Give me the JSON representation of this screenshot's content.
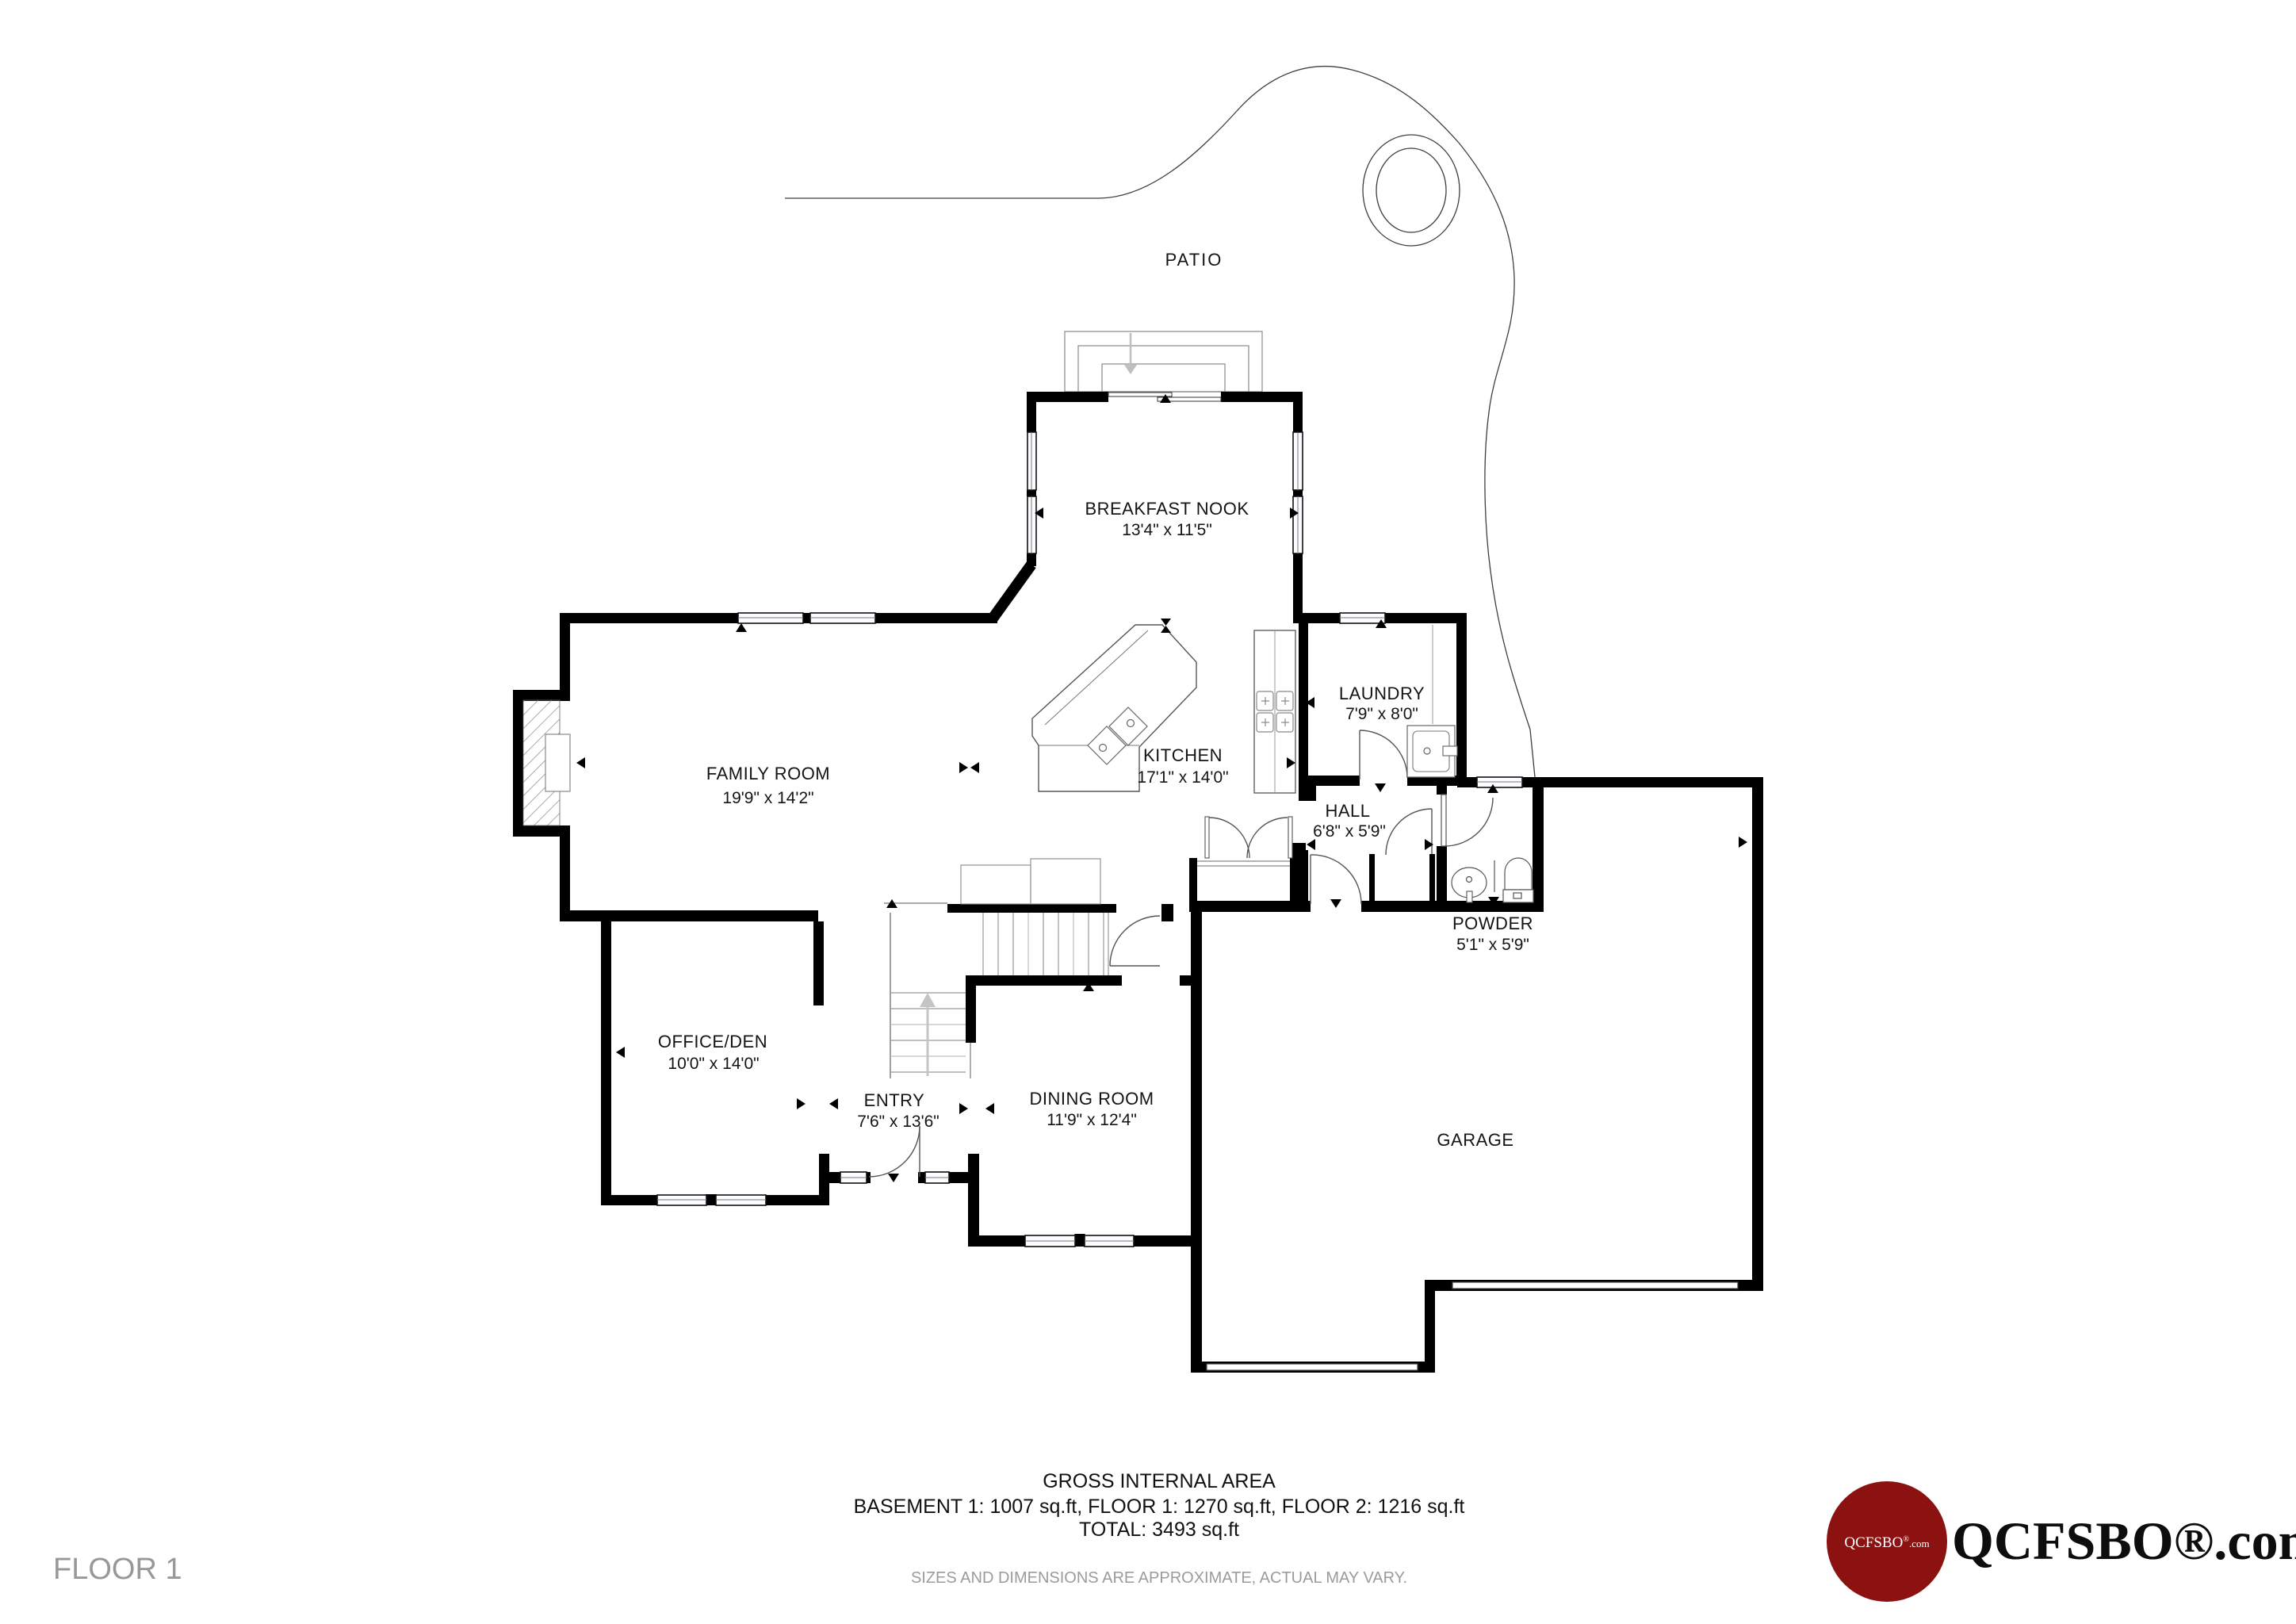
{
  "floor_label": "FLOOR 1",
  "rooms": [
    {
      "name": "PATIO",
      "dims": ""
    },
    {
      "name": "BREAKFAST NOOK",
      "dims": "13'4\" x 11'5\""
    },
    {
      "name": "FAMILY ROOM",
      "dims": "19'9\" x 14'2\""
    },
    {
      "name": "KITCHEN",
      "dims": "17'1\" x 14'0\""
    },
    {
      "name": "LAUNDRY",
      "dims": "7'9\" x 8'0\""
    },
    {
      "name": "HALL",
      "dims": "6'8\" x 5'9\""
    },
    {
      "name": "POWDER",
      "dims": "5'1\" x 5'9\""
    },
    {
      "name": "OFFICE/DEN",
      "dims": "10'0\" x 14'0\""
    },
    {
      "name": "ENTRY",
      "dims": "7'6\" x 13'6\""
    },
    {
      "name": "DINING ROOM",
      "dims": "11'9\" x 12'4\""
    },
    {
      "name": "GARAGE",
      "dims": ""
    }
  ],
  "footer": {
    "title": "GROSS INTERNAL AREA",
    "areas": "BASEMENT 1: 1007 sq.ft, FLOOR 1: 1270 sq.ft, FLOOR 2: 1216 sq.ft",
    "total": "TOTAL: 3493 sq.ft",
    "disclaimer": "SIZES AND DIMENSIONS ARE APPROXIMATE, ACTUAL MAY VARY."
  },
  "logo": {
    "circle_text_main": "QCFSBO",
    "circle_text_reg": "®",
    "circle_text_com": ".com",
    "brand_text": "QCFSBO®.com",
    "circle_color": "#8c1111"
  }
}
